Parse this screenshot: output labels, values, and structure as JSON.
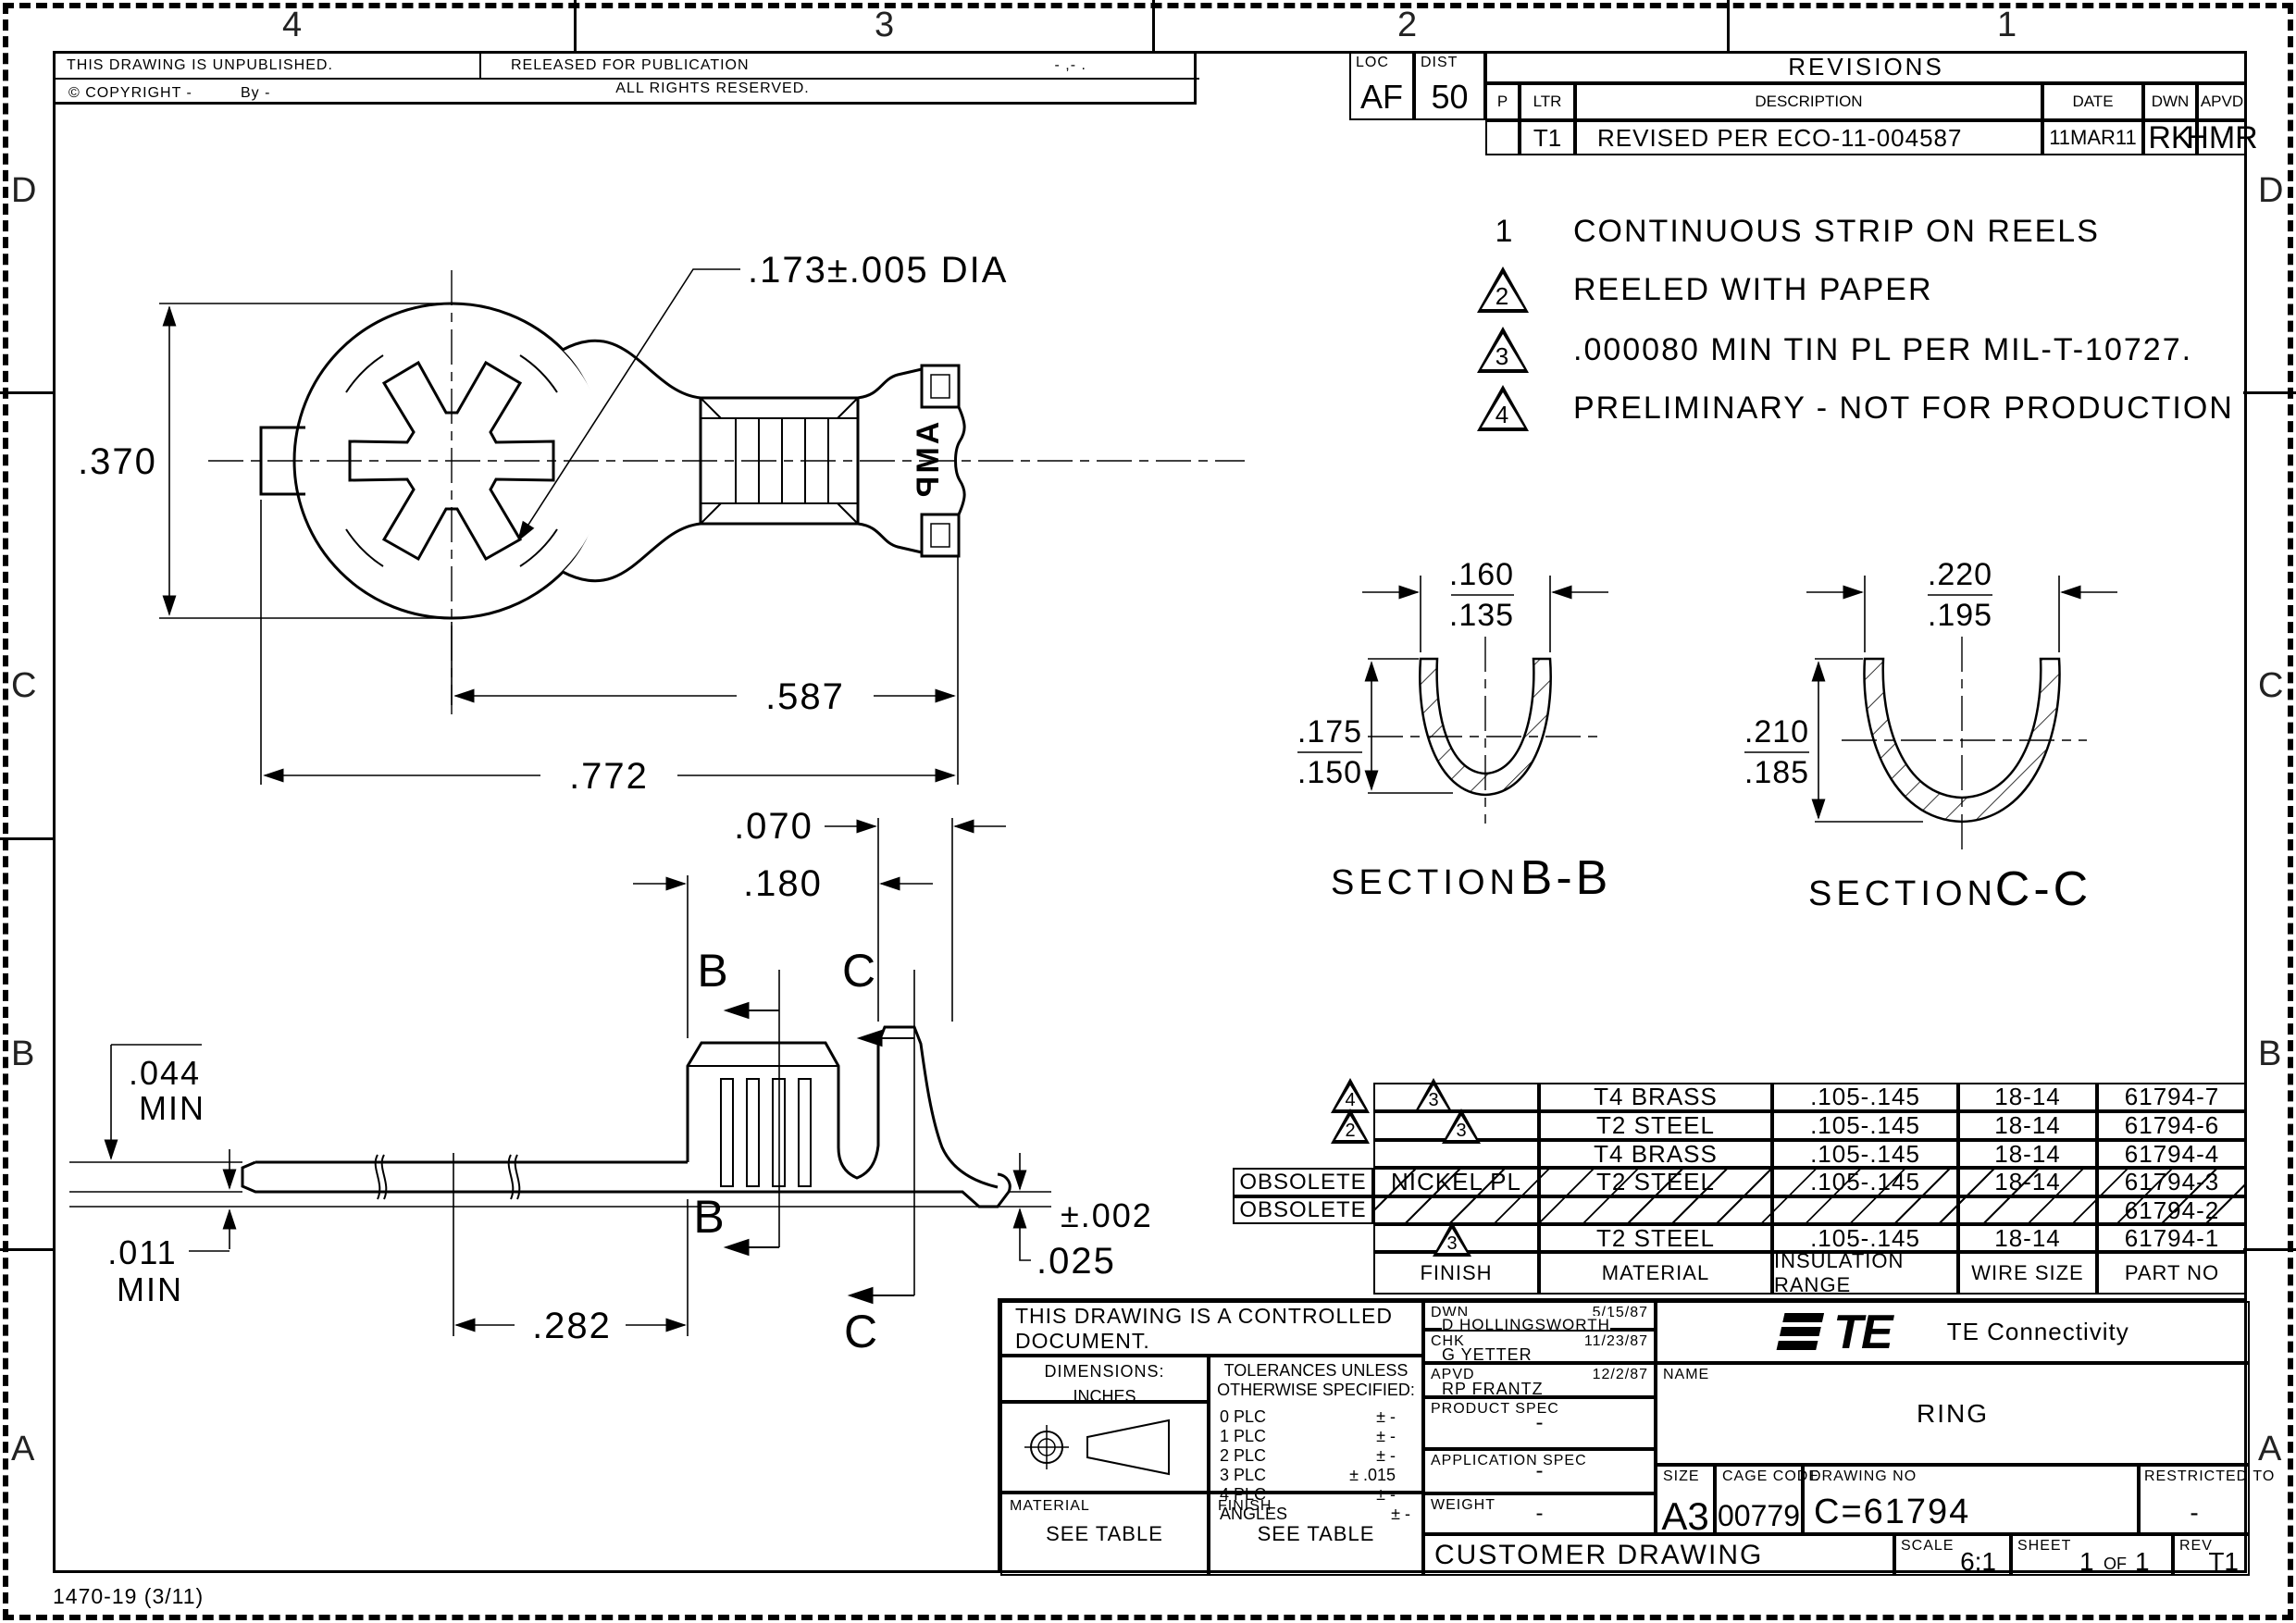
{
  "sheet": {
    "zones_top": [
      "4",
      "3",
      "2",
      "1"
    ],
    "zones_left": [
      "D",
      "C",
      "B",
      "A"
    ],
    "zones_right": [
      "D",
      "C",
      "B",
      "A"
    ],
    "footer": "1470-19  (3/11)"
  },
  "header": {
    "unpublished": "THIS DRAWING IS UNPUBLISHED.",
    "released": "RELEASED FOR PUBLICATION",
    "released_date": "- ,-   .",
    "rights": "ALL RIGHTS RESERVED.",
    "copyright": "© COPYRIGHT -",
    "copyright_by": "By -"
  },
  "revisions": {
    "loc_label": "LOC",
    "loc_value": "AF",
    "dist_label": "DIST",
    "dist_value": "50",
    "title": "REVISIONS",
    "col_p": "P",
    "col_ltr": "LTR",
    "col_description": "DESCRIPTION",
    "col_date": "DATE",
    "col_dwn": "DWN",
    "col_apvd": "APVD",
    "row_ltr": "T1",
    "row_description": "REVISED PER ECO-11-004587",
    "row_date": "11MAR11",
    "row_dwn": "RK",
    "row_apvd": "HMR"
  },
  "notes": [
    {
      "num": "1",
      "text": "CONTINUOUS STRIP ON REELS"
    },
    {
      "num": "2",
      "text": "REELED WITH PAPER"
    },
    {
      "num": "3",
      "text": ".000080 MIN TIN PL PER MIL-T-10727."
    },
    {
      "num": "4",
      "text": "PRELIMINARY - NOT FOR PRODUCTION"
    }
  ],
  "drawing": {
    "top_view": {
      "dia": ".173±.005 DIA",
      "height": ".370",
      "len_587": ".587",
      "len_772": ".772",
      "logo": "AMP"
    },
    "side_view": {
      "d070": ".070",
      "d180": ".180",
      "d044": ".044",
      "min1": "MIN",
      "d011": ".011",
      "min2": "MIN",
      "d282": ".282",
      "tol": "±.002",
      "d025": ".025",
      "b": "B",
      "c": "C"
    },
    "section_b": {
      "section": "SECTION",
      "letters": "B-B",
      "wmax": ".160",
      "wmin": ".135",
      "dmax": ".175",
      "dmin": ".150"
    },
    "section_c": {
      "section": "SECTION",
      "letters": "C-C",
      "wmax": ".220",
      "wmin": ".195",
      "dmax": ".210",
      "dmin": ".185"
    }
  },
  "parts_table": {
    "col_finish": "FINISH",
    "col_material": "MATERIAL",
    "col_insulation": "INSULATION RANGE",
    "col_wire": "WIRE SIZE",
    "col_part": "PART NO",
    "rows": [
      {
        "flag": "4",
        "finish_flag": "3",
        "finish": "",
        "material": "T4 BRASS",
        "insulation": ".105-.145",
        "wire": "18-14",
        "part": "61794-7",
        "obsolete": ""
      },
      {
        "flag": "2",
        "finish_flag": "3",
        "finish": "",
        "material": "T2 STEEL",
        "insulation": ".105-.145",
        "wire": "18-14",
        "part": "61794-6",
        "obsolete": ""
      },
      {
        "flag": "",
        "finish_flag": "",
        "finish": "",
        "material": "T4 BRASS",
        "insulation": ".105-.145",
        "wire": "18-14",
        "part": "61794-4",
        "obsolete": ""
      },
      {
        "flag": "",
        "finish_flag": "",
        "finish": "NICKEL PL",
        "material": "T2 STEEL",
        "insulation": ".105-.145",
        "wire": "18-14",
        "part": "61794-3",
        "obsolete": "OBSOLETE"
      },
      {
        "flag": "",
        "finish_flag": "",
        "finish": "",
        "material": "",
        "insulation": "",
        "wire": "",
        "part": "61794-2",
        "obsolete": "OBSOLETE"
      },
      {
        "flag": "",
        "finish_flag": "3",
        "finish": "",
        "material": "T2 STEEL",
        "insulation": ".105-.145",
        "wire": "18-14",
        "part": "61794-1",
        "obsolete": ""
      }
    ]
  },
  "title_block": {
    "controlled": "THIS DRAWING IS A CONTROLLED DOCUMENT.",
    "dimensions_label": "DIMENSIONS:",
    "units": "INCHES",
    "tol_title1": "TOLERANCES UNLESS",
    "tol_title2": "OTHERWISE SPECIFIED:",
    "tolerances": [
      [
        "0 PLC",
        "± -"
      ],
      [
        "1 PLC",
        "± -"
      ],
      [
        "2 PLC",
        "± -"
      ],
      [
        "3 PLC",
        "± .015"
      ],
      [
        "4 PLC",
        "± -"
      ],
      [
        "ANGLES",
        "± -"
      ]
    ],
    "material_label": "MATERIAL",
    "material_value": "SEE TABLE",
    "finish_label": "FINISH",
    "finish_value": "SEE TABLE",
    "dwn_label": "DWN",
    "dwn_name": "D HOLLINGSWORTH",
    "dwn_date": "5/15/87",
    "chk_label": "CHK",
    "chk_name": "G YETTER",
    "chk_date": "11/23/87",
    "apvd_label": "APVD",
    "apvd_name": "RP FRANTZ",
    "apvd_date": "12/2/87",
    "product_spec_label": "PRODUCT SPEC",
    "product_spec_value": "-",
    "application_spec_label": "APPLICATION SPEC",
    "application_spec_value": "-",
    "weight_label": "WEIGHT",
    "weight_value": "-",
    "customer": "CUSTOMER DRAWING",
    "logo_text": "TE",
    "company": "TE Connectivity",
    "name_label": "NAME",
    "name_value": "RING",
    "size_label": "SIZE",
    "size_value": "A3",
    "cage_label": "CAGE CODE",
    "cage_value": "00779",
    "drawing_no_label": "DRAWING NO",
    "drawing_no_value": "C=61794",
    "restricted_label": "RESTRICTED TO",
    "restricted_value": "-",
    "scale_label": "SCALE",
    "scale_value": "6:1",
    "sheet_label": "SHEET",
    "sheet_value": "1",
    "sheet_of": "OF",
    "sheet_total": "1",
    "rev_label": "REV",
    "rev_value": "T1"
  }
}
